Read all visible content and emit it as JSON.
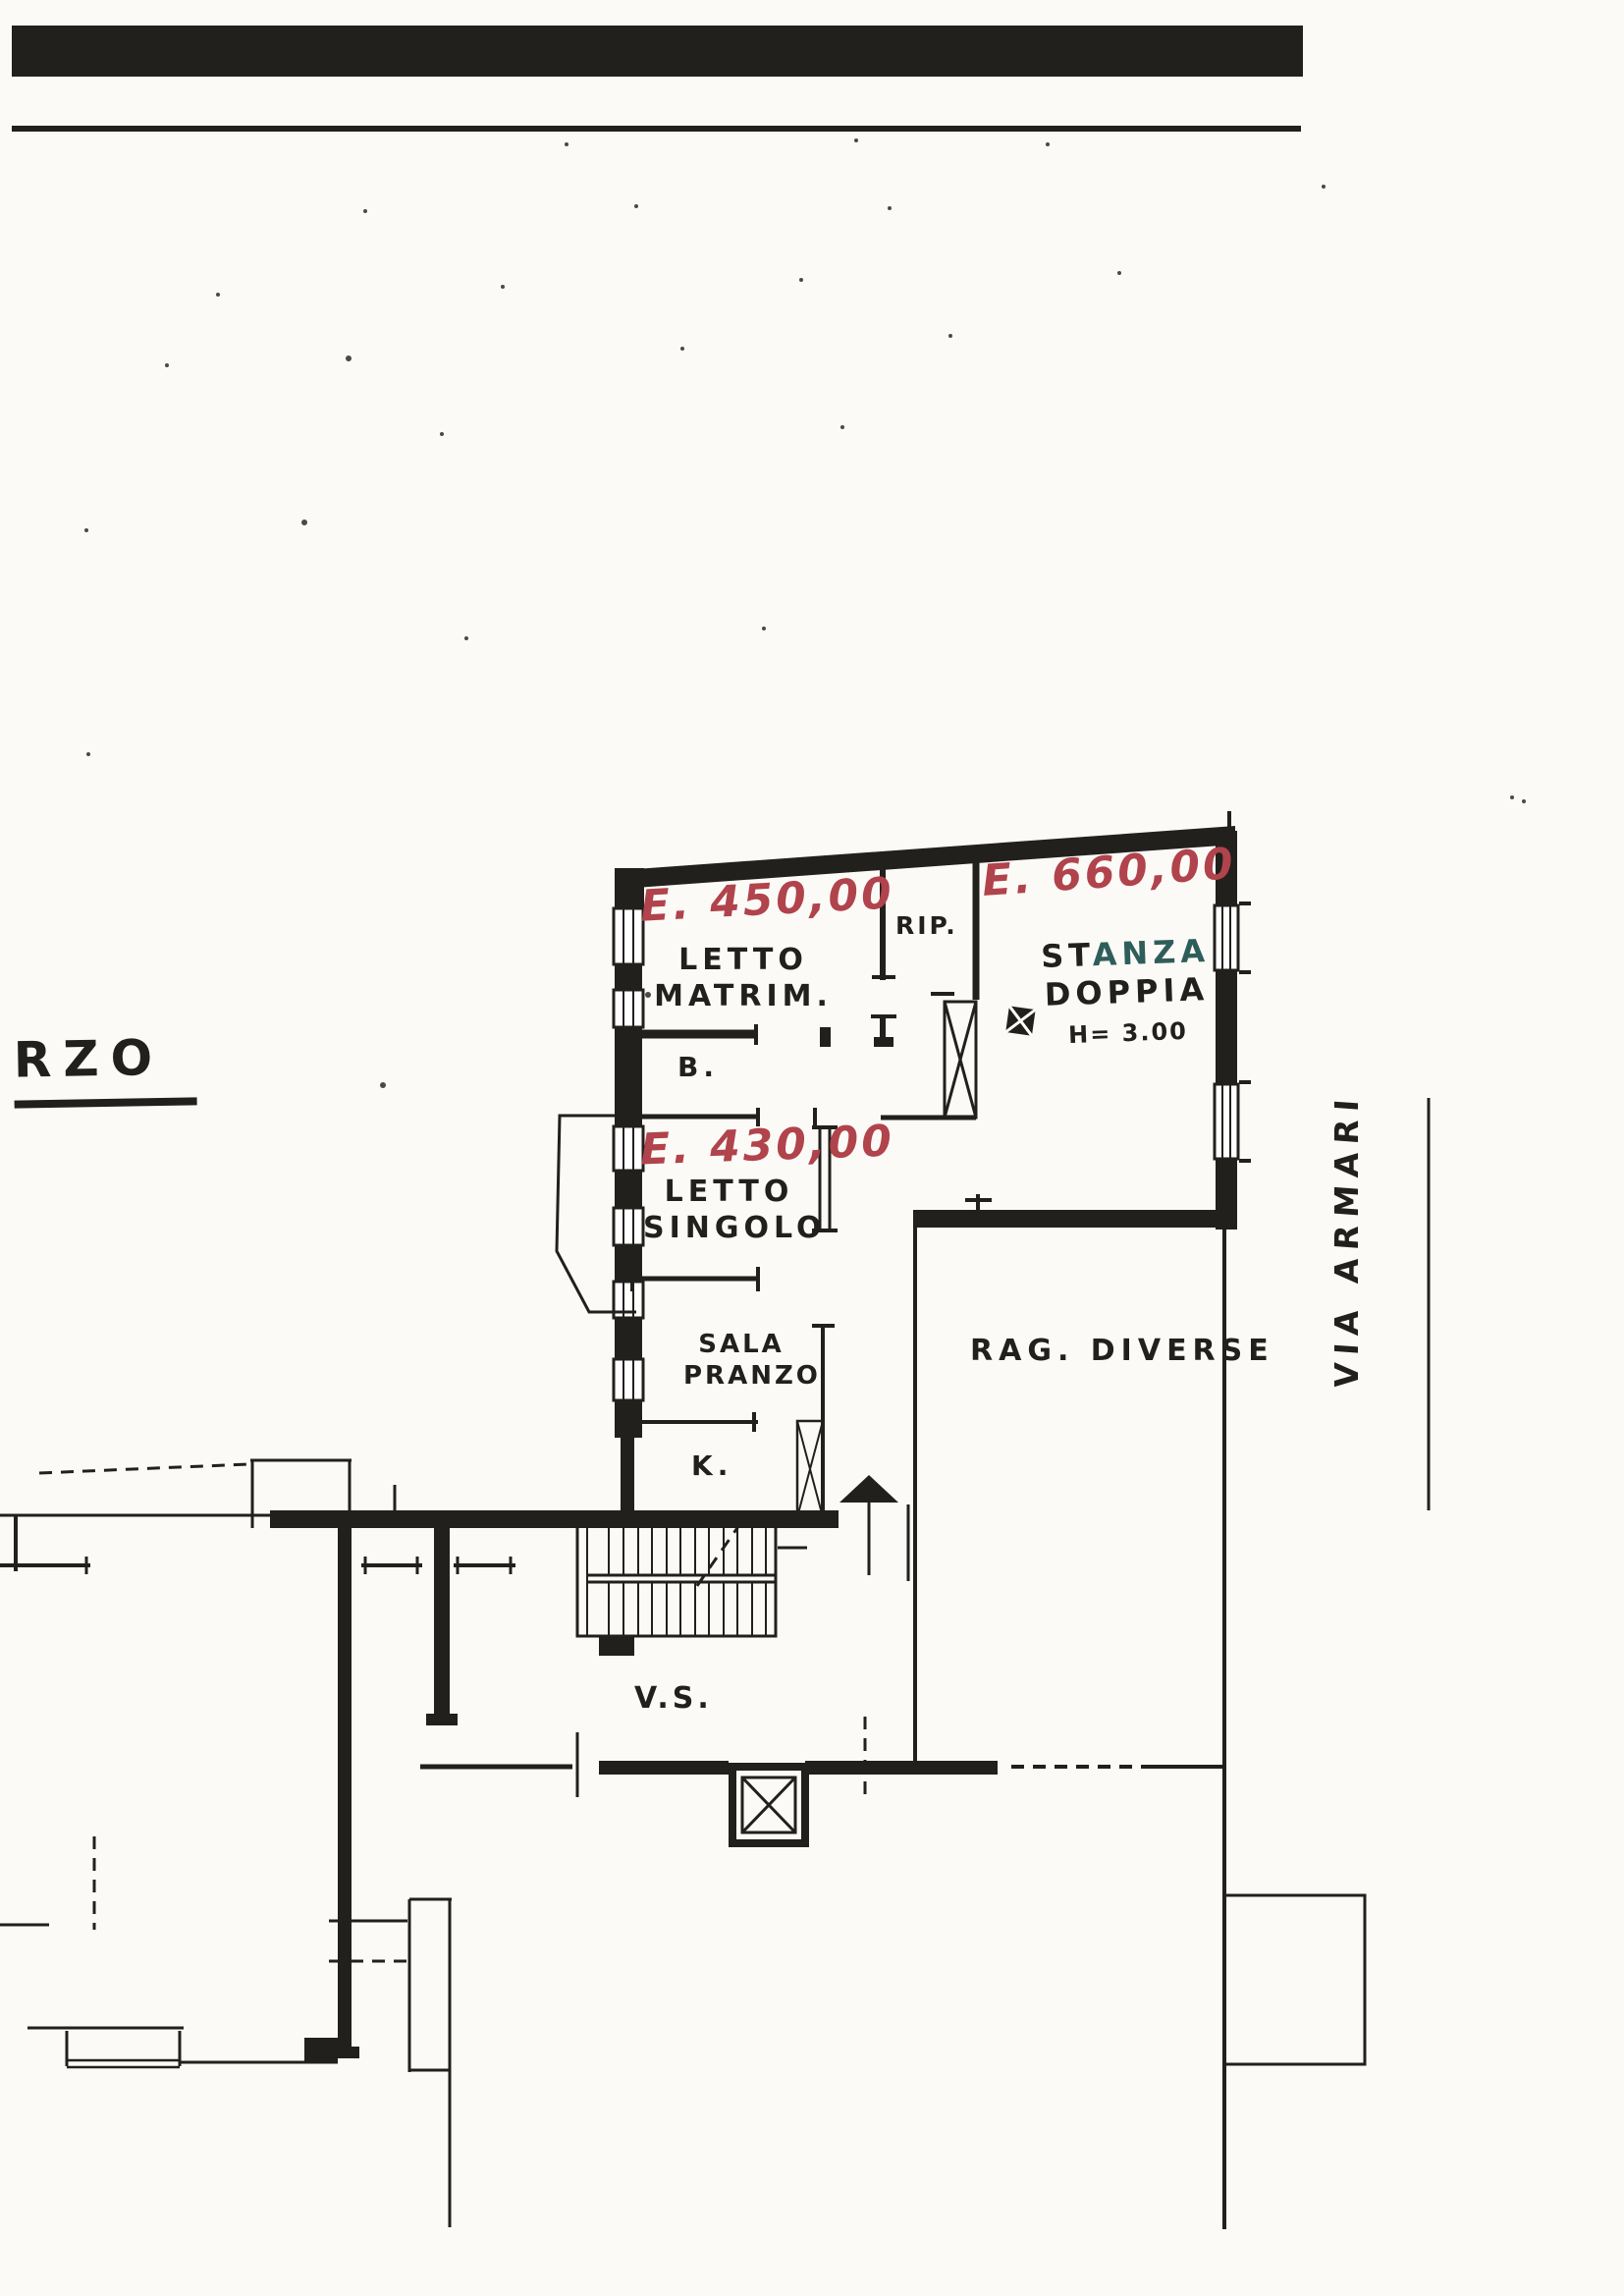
{
  "page": {
    "plan_fragment_label": "RZO",
    "street_name": "VIA ARMARI"
  },
  "annotations": {
    "price_letto_matrim": "E. 450,00",
    "price_stanza_doppia": "E. 660,00",
    "price_letto_singolo": "E. 430,00"
  },
  "rooms": {
    "letto_matrim_line1": "LETTO",
    "letto_matrim_line2": "MATRIM.",
    "bagno": "B.",
    "ripostiglio": "RIP.",
    "stanza_part1": "ST",
    "stanza_part2": "ANZA",
    "doppia": "DOPPIA",
    "altezza": "H= 3.00",
    "letto_singolo_line1": "LETTO",
    "letto_singolo_line2": "SINGOLO",
    "sala_line1": "SALA",
    "sala_line2": "PRANZO",
    "cucina": "K.",
    "rag_diverse": "RAG. DIVERSE",
    "vano_scala": "V.S."
  },
  "colors": {
    "ink": "#21201d",
    "annotation_red": "#b0434b",
    "annotation_teal": "#2f5e5a",
    "paper": "#fbfaf7"
  }
}
